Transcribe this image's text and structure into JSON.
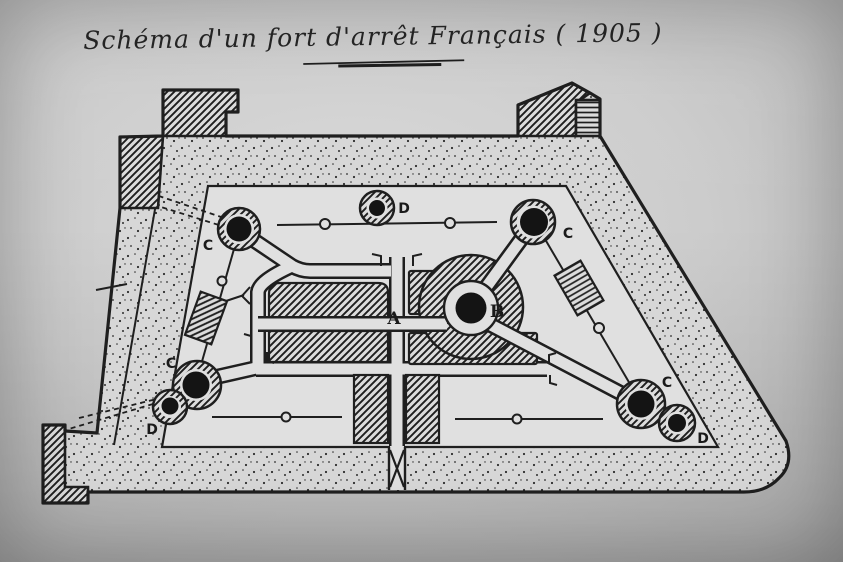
{
  "title": {
    "text": "Schéma d'un fort d'arrêt Français ( 1905 )"
  },
  "labels": {
    "turret_c_upper_left": "C",
    "observation_d_top": "D",
    "turret_c_upper_right": "C",
    "barracks_a": "A",
    "turret_b_central": "B",
    "turret_c_lower_left": "C",
    "observation_d_lower_left": "D",
    "turret_c_lower_right": "C",
    "observation_d_lower_right": "D"
  },
  "colors": {
    "ink": "#1f1f1f",
    "paper": "#e0e0e0",
    "paper_band": "#d7d7d7",
    "core_black": "#141414"
  }
}
